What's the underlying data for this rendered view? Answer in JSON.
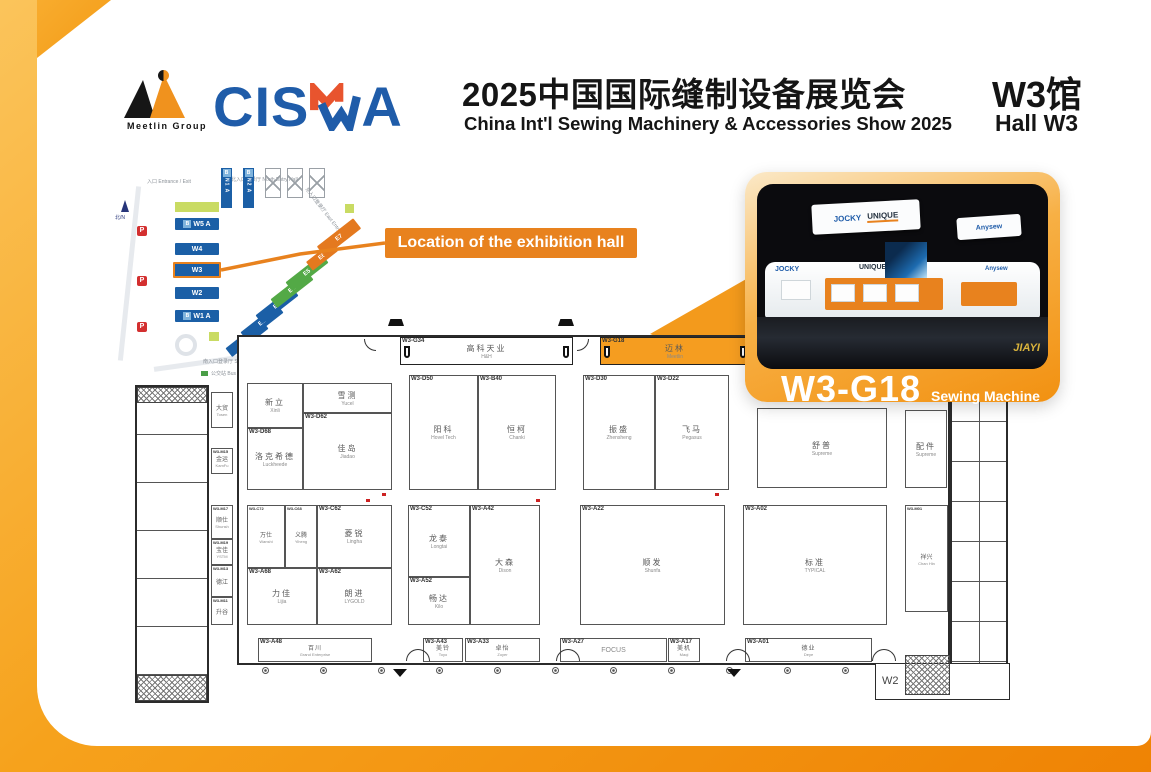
{
  "header": {
    "group_name": "Meetlin Group",
    "brand_left": "CIS",
    "brand_right": "A",
    "title_cn": "2025中国国际缝制设备展览会",
    "title_en": "China Int'l Sewing Machinery & Accessories Show 2025",
    "hall_cn": "W3馆",
    "hall_en": "Hall W3"
  },
  "colors": {
    "accent_orange": "#E8821E",
    "brand_blue": "#1F5CA9",
    "brand_orange": "#E8542E",
    "highlight_booth": "#F59D20",
    "hall_blue": "#1B5FA6",
    "hall_green": "#53A946",
    "hall_orange": "#E4791F"
  },
  "callout": {
    "text": "Location of the exhibition hall"
  },
  "minimap": {
    "compass": "北/N",
    "entrance_label": "入口 Entrance / Exit",
    "north_entry": "北入口登录厅 North Entry Hall",
    "east_entry": "东入口登录厅 East Entry Hall",
    "south_entry": "南入口登录厅 South Entry Hall",
    "bus_station": "公交站 Bus Station",
    "road": "龙阳路 / Longyang Road",
    "parking": "P",
    "west_halls": [
      {
        "prefix": "B",
        "label": "W5 A"
      },
      {
        "label": "W4"
      },
      {
        "label": "W3"
      },
      {
        "label": "W2"
      },
      {
        "prefix": "B",
        "label": "W1 A"
      }
    ],
    "north_halls": [
      {
        "prefix": "B",
        "label": "N1 A"
      },
      {
        "prefix": "B",
        "label": "N2 A"
      }
    ],
    "east_halls": [
      {
        "label": "E1 A"
      },
      {
        "label": "E2"
      },
      {
        "label": "E3"
      },
      {
        "label": "E4"
      },
      {
        "label": "E5"
      },
      {
        "label": "E6"
      },
      {
        "label": "E7"
      }
    ]
  },
  "card": {
    "banner1_left": "JOCKY",
    "banner1_right": "UNIQUE",
    "banner2": "Anysew",
    "wall_left": "JOCKY",
    "wall_center": "UNIQUE",
    "wall_right": "Anysew",
    "watermark": "JIAYI",
    "booth_no": "W3-G18",
    "category": "Sewing Machine"
  },
  "plan": {
    "w2_label": "W2",
    "gates": [
      {
        "id": "W3-G34",
        "cn": "高科天业",
        "en": "H&H"
      },
      {
        "id": "W3-G18",
        "cn": "迈林",
        "en": "Meetlin"
      }
    ],
    "booths": [
      {
        "id": "W3-D68",
        "cn": "洛克希德",
        "en": "Luckheede"
      },
      {
        "id": "",
        "cn": "新立",
        "en": "Xinli"
      },
      {
        "id": "",
        "cn": "雪测",
        "en": "Yucel"
      },
      {
        "id": "W3-D62",
        "cn": "佳岛",
        "en": "Jiadao"
      },
      {
        "id": "W3-D50",
        "cn": "阳科",
        "en": "Hovel Tech"
      },
      {
        "id": "W3-B40",
        "cn": "恒柯",
        "en": "Chanki"
      },
      {
        "id": "W3-D30",
        "cn": "振盛",
        "en": "Zhensheng"
      },
      {
        "id": "W3-D22",
        "cn": "飞马",
        "en": "Pegasus"
      },
      {
        "id": "",
        "cn": "舒普",
        "en": "Supreme"
      },
      {
        "id": "",
        "cn": "配件",
        "en": "Supreme"
      },
      {
        "id": "W3-C72",
        "cn": "万仕",
        "en": "Wanshi"
      },
      {
        "id": "W3-C68",
        "cn": "义腾",
        "en": "Yiheng"
      },
      {
        "id": "W3-C62",
        "cn": "菱锐",
        "en": "Lingha"
      },
      {
        "id": "W3-A68",
        "cn": "力佳",
        "en": "Lijia"
      },
      {
        "id": "W3-A62",
        "cn": "朗进",
        "en": "LYGOLD"
      },
      {
        "id": "W3-C52",
        "cn": "龙泰",
        "en": "Longtai"
      },
      {
        "id": "W3-A52",
        "cn": "畅达",
        "en": "Kilo"
      },
      {
        "id": "W3-A42",
        "cn": "大森",
        "en": "Dison"
      },
      {
        "id": "W3-A22",
        "cn": "顺发",
        "en": "Shunfa"
      },
      {
        "id": "W3-A02",
        "cn": "标准",
        "en": "TYPICAL"
      },
      {
        "id": "W3-M01",
        "cn": "祥兴",
        "en": "Chan Hin"
      },
      {
        "id": "W3-A48",
        "cn": "百川",
        "en": "Grand Enterprise"
      },
      {
        "id": "W3-A43",
        "cn": "美铃",
        "en": "Toyo"
      },
      {
        "id": "W3-A33",
        "cn": "卓怡",
        "en": "Zoyer"
      },
      {
        "id": "W3-A27",
        "cn": "",
        "en": "FOCUS"
      },
      {
        "id": "W3-A17",
        "cn": "美机",
        "en": "Maqi"
      },
      {
        "id": "W3-A01",
        "cn": "德业",
        "en": "Deye"
      }
    ],
    "side_booths": [
      {
        "id": "",
        "cn": "大贸",
        "en": "Tosen"
      },
      {
        "id": "W3-M15",
        "cn": "金运",
        "en": "KamFu"
      },
      {
        "id": "W3-M17",
        "cn": "顺仕",
        "en": "Shunsh"
      },
      {
        "id": "W3-M19",
        "cn": "宝佳",
        "en": "YSTM"
      },
      {
        "id": "W3-M13",
        "cn": "德江",
        "en": ""
      },
      {
        "id": "W3-M11",
        "cn": "升谷",
        "en": ""
      }
    ]
  }
}
